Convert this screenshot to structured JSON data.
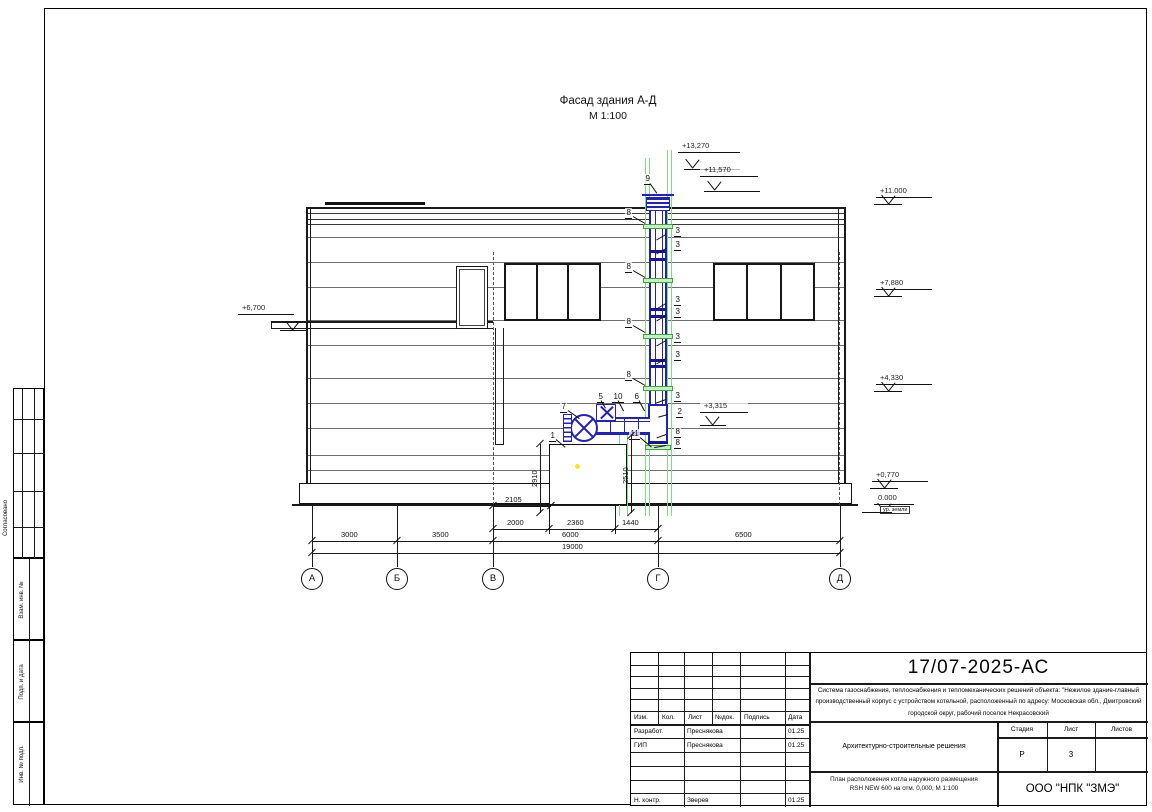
{
  "drawing": {
    "title": "Фасад здания А-Д",
    "scale": "М 1:100",
    "axes": [
      "А",
      "Б",
      "В",
      "Г",
      "Д"
    ],
    "elevations": {
      "top1": "+13,270",
      "top2": "+11,570",
      "r11000": "+11.000",
      "r7880": "+7,880",
      "r4330": "+4,330",
      "r0770": "+0,770",
      "zero": "0.000",
      "ground": "ур. земли",
      "left6700": "+6,700",
      "duct3315": "+3,315"
    },
    "dims": {
      "upper": "2105",
      "sub": [
        "2000",
        "2360",
        "1440"
      ],
      "spans": [
        "3000",
        "3500",
        "6000",
        "6500"
      ],
      "total": "19000",
      "v1": "2910",
      "v2": "2510"
    },
    "callouts": {
      "n1": "1",
      "n2": "2",
      "n3": "3",
      "n5": "5",
      "n6": "6",
      "n7": "7",
      "n8": "8",
      "n9": "9",
      "n10": "10",
      "n11": "11"
    }
  },
  "titleblock": {
    "doc_number": "17/07-2025-АС",
    "description": "Система газоснабжения, теплоснабжения и тепломеханических решений объекта: \"Нежилое здание-главный производственный корпус с устройством котельной, расположенный по адресу: Московская обл., Дмитровский городской округ, рабочий поселок Некрасовский",
    "section": "Архитектурно-строительные решения",
    "subject_line1": "План расположения котла наружного размещения",
    "subject_line2": "RSH NEW 600 на отм. 0,000,  М 1:100",
    "company": "ООО \"НПК \"ЗМЭ\"",
    "cols": {
      "izm": "Изм.",
      "kol": "Кол.",
      "list": "Лист",
      "ndoc": "№док.",
      "podpis": "Подпись",
      "data": "Дата"
    },
    "stage_label": "Стадия",
    "sheet_label": "Лист",
    "sheets_label": "Листов",
    "stage": "Р",
    "sheet": "3",
    "rows": [
      {
        "role": "Разработ.",
        "name": "Преснякова",
        "date": "01.25"
      },
      {
        "role": "ГИП",
        "name": "Преснякова",
        "date": "01.25"
      },
      {
        "role": "Н. контр.",
        "name": "Зверев",
        "date": "01.25"
      }
    ]
  },
  "margin": {
    "agreed": "Согласовано",
    "vzam": "Взам. инв. №",
    "podp": "Подп. и дата",
    "inv": "Инв. № подл."
  },
  "colors": {
    "flue_blue": "#2121bb",
    "clamp_green": "#43a043",
    "guide_green": "#7edc7e",
    "marker_yellow": "#f4e81c"
  }
}
